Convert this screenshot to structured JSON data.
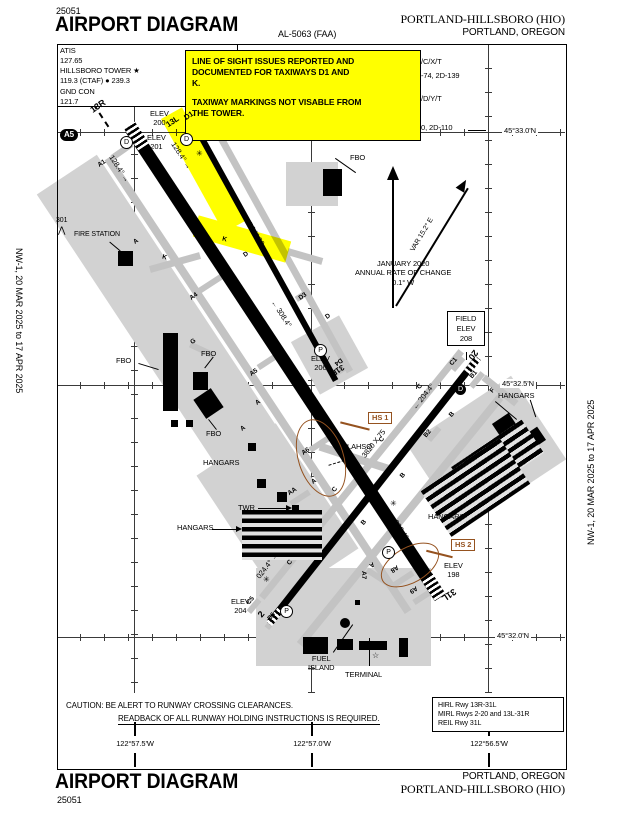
{
  "header": {
    "chart_code": "25051",
    "title": "AIRPORT DIAGRAM",
    "procedure_id": "AL-5063 (FAA)",
    "airport_name": "PORTLAND-HILLSBORO (HIO)",
    "city": "PORTLAND, OREGON"
  },
  "footer": {
    "title": "AIRPORT DIAGRAM",
    "chart_code": "25051",
    "city": "PORTLAND, OREGON",
    "airport_name": "PORTLAND-HILLSBORO (HIO)"
  },
  "margins": {
    "edition": "NW-1,  20 MAR 2025  to  17 APR 2025"
  },
  "comms": {
    "lines": [
      "ATIS",
      "127.65",
      "HILLSBORO TOWER ★",
      "119.3 (CTAF) ● 239.3",
      "GND CON",
      "121.7"
    ]
  },
  "note_box": {
    "lines": [
      "LINE OF SIGHT ISSUES REPORTED AND",
      "DOCUMENTED FOR TAXIWAYS D1 AND",
      "K.",
      "",
      "TAXIWAY MARKINGS NOT VISABLE FROM",
      "THE TOWER."
    ]
  },
  "runway_data_fragments": [
    "/C/X/T",
    "-74, 2D-139",
    "/D/Y/T",
    "0, 2D-110"
  ],
  "north_group": {
    "variation": "VAR 15.2° E",
    "annual": "JANUARY 2020\nANNUAL RATE OF CHANGE\n0.1° W"
  },
  "graticule": {
    "lat_labels": [
      "45°33.0'N",
      "45°32.5'N",
      "45°32.0'N"
    ],
    "lon_labels": [
      "122°57.5'W",
      "122°57.0'W",
      "122°56.5'W"
    ]
  },
  "caution": {
    "line1": "CAUTION: BE ALERT TO RUNWAY CROSSING CLEARANCES.",
    "line2": "READBACK OF ALL RUNWAY HOLDING INSTRUCTIONS IS REQUIRED."
  },
  "lighting_box": {
    "lines": [
      "HIRL Rwy 13R-31L",
      "MIRL Rwys 2-20 and 13L-31R",
      "REIL Rwy 31L"
    ]
  },
  "field_elev_box": {
    "lines": [
      "FIELD",
      "ELEV",
      "208"
    ]
  },
  "hotspots": [
    {
      "label": "HS 1"
    },
    {
      "label": "HS 2"
    }
  ],
  "colors": {
    "highlight": "#ffff00",
    "hotspot_brown": "#95521f",
    "taxiway_gray": "#c3c3c3"
  },
  "map": {
    "labels": [
      {
        "t": "13R",
        "x": 90,
        "y": 101,
        "r": -34,
        "fs": 9,
        "b": 1
      },
      {
        "t": "13L",
        "x": 166,
        "y": 117,
        "r": -34,
        "fs": 8,
        "b": 1
      },
      {
        "t": "D1",
        "x": 184,
        "y": 111,
        "r": -34,
        "fs": 7.5,
        "b": 1
      },
      {
        "t": "31R",
        "x": 330,
        "y": 365,
        "r": 146,
        "fs": 8,
        "b": 1
      },
      {
        "t": "31L",
        "x": 441,
        "y": 589,
        "r": 146,
        "fs": 9,
        "b": 1
      },
      {
        "t": "2",
        "x": 259,
        "y": 609,
        "r": -50,
        "fs": 9,
        "b": 1
      },
      {
        "t": "20",
        "x": 468,
        "y": 349,
        "r": 128,
        "fs": 9,
        "b": 1
      },
      {
        "t": "128.4° →",
        "x": 104,
        "y": 164,
        "r": 57,
        "fs": 7.5
      },
      {
        "t": "128.4° →",
        "x": 166,
        "y": 151,
        "r": 57,
        "fs": 7.5
      },
      {
        "t": "← 308.4°",
        "x": 266,
        "y": 309,
        "r": 57,
        "fs": 7.5
      },
      {
        "t": "← 308.4°",
        "x": 383,
        "y": 521,
        "r": 57,
        "fs": 7.5
      },
      {
        "t": "6600 X 150",
        "x": 247,
        "y": 327,
        "r": 57,
        "fs": 8.5
      },
      {
        "t": "3600 X 60",
        "x": 237,
        "y": 226,
        "r": 58,
        "fs": 7.5
      },
      {
        "t": "3820 X 75",
        "x": 357,
        "y": 439,
        "r": -52,
        "fs": 7.5
      },
      {
        "t": "024.4° →",
        "x": 252,
        "y": 561,
        "r": -52,
        "fs": 7.5
      },
      {
        "t": "← 204.4°",
        "x": 408,
        "y": 392,
        "r": -52,
        "fs": 7.5
      },
      {
        "t": "ELEV\n200",
        "x": 150,
        "y": 109,
        "fs": 7.5,
        "pre": 1
      },
      {
        "t": "ELEV\n201",
        "x": 147,
        "y": 133,
        "fs": 7.5,
        "pre": 1
      },
      {
        "t": "ELEV\n206",
        "x": 311,
        "y": 354,
        "fs": 7.5,
        "pre": 1
      },
      {
        "t": "ELEV\n204",
        "x": 231,
        "y": 597,
        "fs": 7.5,
        "pre": 1
      },
      {
        "t": "ELEV\n198",
        "x": 444,
        "y": 561,
        "fs": 7.5,
        "pre": 1
      },
      {
        "t": "A1",
        "x": 98,
        "y": 160,
        "r": -34,
        "fs": 6.5,
        "b": 1
      },
      {
        "t": "A",
        "x": 134,
        "y": 238,
        "r": -34,
        "fs": 6.5,
        "b": 1
      },
      {
        "t": "A4",
        "x": 190,
        "y": 293,
        "r": -34,
        "fs": 6.5,
        "b": 1
      },
      {
        "t": "A5",
        "x": 250,
        "y": 369,
        "r": -34,
        "fs": 6.5,
        "b": 1
      },
      {
        "t": "A",
        "x": 256,
        "y": 399,
        "r": -34,
        "fs": 6.5,
        "b": 1
      },
      {
        "t": "A",
        "x": 241,
        "y": 425,
        "r": -34,
        "fs": 6.5,
        "b": 1
      },
      {
        "t": "A6",
        "x": 302,
        "y": 448,
        "r": -34,
        "fs": 6.5,
        "b": 1
      },
      {
        "t": "A",
        "x": 312,
        "y": 478,
        "r": -34,
        "fs": 6.5,
        "b": 1
      },
      {
        "t": "AA",
        "x": 288,
        "y": 488,
        "r": -34,
        "fs": 6.5,
        "b": 1
      },
      {
        "t": "A7",
        "x": 359,
        "y": 571,
        "r": 90,
        "fs": 6.5,
        "b": 1
      },
      {
        "t": "A",
        "x": 369,
        "y": 560,
        "r": 146,
        "fs": 6.5,
        "b": 1
      },
      {
        "t": "A8",
        "x": 390,
        "y": 564,
        "r": 146,
        "fs": 6.5,
        "b": 1
      },
      {
        "t": "A9",
        "x": 409,
        "y": 585,
        "r": 146,
        "fs": 6.5,
        "b": 1
      },
      {
        "t": "B",
        "x": 450,
        "y": 411,
        "r": -50,
        "fs": 6.5,
        "b": 1
      },
      {
        "t": "B2",
        "x": 424,
        "y": 430,
        "r": -50,
        "fs": 6.5,
        "b": 1
      },
      {
        "t": "B",
        "x": 401,
        "y": 472,
        "r": -50,
        "fs": 6.5,
        "b": 1
      },
      {
        "t": "B",
        "x": 362,
        "y": 519,
        "r": -50,
        "fs": 6.5,
        "b": 1
      },
      {
        "t": "B5",
        "x": 268,
        "y": 613,
        "r": -50,
        "fs": 6.5,
        "b": 1
      },
      {
        "t": "B1",
        "x": 470,
        "y": 371,
        "r": -50,
        "fs": 6.5,
        "b": 1
      },
      {
        "t": "C",
        "x": 418,
        "y": 383,
        "r": -50,
        "fs": 6.5,
        "b": 1
      },
      {
        "t": "C1",
        "x": 450,
        "y": 358,
        "r": -50,
        "fs": 6.5,
        "b": 1
      },
      {
        "t": "C",
        "x": 380,
        "y": 436,
        "r": -50,
        "fs": 6.5,
        "b": 1
      },
      {
        "t": "C",
        "x": 333,
        "y": 486,
        "r": -50,
        "fs": 6.5,
        "b": 1
      },
      {
        "t": "C",
        "x": 288,
        "y": 559,
        "r": -50,
        "fs": 6.5,
        "b": 1
      },
      {
        "t": "C5",
        "x": 247,
        "y": 597,
        "r": -50,
        "fs": 6.5,
        "b": 1
      },
      {
        "t": "D",
        "x": 244,
        "y": 251,
        "r": -34,
        "fs": 6.5,
        "b": 1
      },
      {
        "t": "D3",
        "x": 299,
        "y": 293,
        "r": -34,
        "fs": 6.5,
        "b": 1
      },
      {
        "t": "D",
        "x": 326,
        "y": 313,
        "r": -34,
        "fs": 6.5,
        "b": 1
      },
      {
        "t": "D4",
        "x": 334,
        "y": 357,
        "r": 146,
        "fs": 6.5,
        "b": 1
      },
      {
        "t": "F",
        "x": 491,
        "y": 387,
        "r": -50,
        "fs": 6.5,
        "b": 1
      },
      {
        "t": "G",
        "x": 191,
        "y": 338,
        "r": -34,
        "fs": 6.5,
        "b": 1
      },
      {
        "t": "K",
        "x": 162,
        "y": 254,
        "r": 14,
        "fs": 6.5,
        "b": 1
      },
      {
        "t": "K",
        "x": 222,
        "y": 236,
        "r": 14,
        "fs": 6.5,
        "b": 1
      },
      {
        "t": "K",
        "x": 247,
        "y": 221,
        "r": 14,
        "fs": 6.5,
        "b": 1
      },
      {
        "t": "FIRE STATION",
        "x": 74,
        "y": 231,
        "fs": 7
      },
      {
        "t": "301",
        "x": 56,
        "y": 217,
        "fs": 7
      },
      {
        "t": "⋀",
        "x": 58,
        "y": 225,
        "fs": 9
      },
      {
        "t": "FBO",
        "x": 350,
        "y": 153,
        "fs": 7.5
      },
      {
        "t": "FBO",
        "x": 116,
        "y": 356,
        "fs": 7.5
      },
      {
        "t": "FBO",
        "x": 201,
        "y": 349,
        "fs": 7.5
      },
      {
        "t": "FBO",
        "x": 206,
        "y": 429,
        "fs": 7.5
      },
      {
        "t": "HANGARS",
        "x": 203,
        "y": 458,
        "fs": 7.5
      },
      {
        "t": "HANGARS",
        "x": 177,
        "y": 523,
        "fs": 7.5
      },
      {
        "t": "HANGARS",
        "x": 498,
        "y": 391,
        "fs": 7.5
      },
      {
        "t": "HANGARS",
        "x": 428,
        "y": 512,
        "fs": 7.5
      },
      {
        "t": "TWR",
        "x": 238,
        "y": 503,
        "fs": 7.5
      },
      {
        "t": "LAHSO",
        "x": 347,
        "y": 442,
        "fs": 7.5
      },
      {
        "t": "TERMINAL",
        "x": 345,
        "y": 670,
        "fs": 7.5
      },
      {
        "t": "FUEL\nISLAND",
        "x": 308,
        "y": 654,
        "fs": 7.5,
        "pre": 1
      },
      {
        "t": "266",
        "x": 372,
        "y": 642,
        "fs": 7
      },
      {
        "t": "☆",
        "x": 372,
        "y": 651,
        "fs": 8
      },
      {
        "t": "VAR 15.2° E",
        "x": 404,
        "y": 231,
        "r": -59,
        "fs": 7
      },
      {
        "t": "JANUARY 2020\nANNUAL RATE OF CHANGE\n0.1° W",
        "x": 355,
        "y": 259,
        "fs": 7.5,
        "pre": 1
      },
      {
        "t": "✳",
        "x": 390,
        "y": 499,
        "fs": 8
      },
      {
        "t": "✳",
        "x": 263,
        "y": 575,
        "fs": 8
      },
      {
        "t": "✳",
        "x": 196,
        "y": 149,
        "fs": 8
      },
      {
        "t": "P",
        "x": 314,
        "y": 344,
        "c": "circ"
      },
      {
        "t": "P",
        "x": 280,
        "y": 605,
        "c": "circ"
      },
      {
        "t": "P",
        "x": 382,
        "y": 546,
        "c": "circ"
      },
      {
        "t": "D",
        "x": 120,
        "y": 136,
        "c": "circ"
      },
      {
        "t": "D",
        "x": 180,
        "y": 133,
        "c": "circ"
      },
      {
        "t": "D",
        "x": 455,
        "y": 384,
        "c": "circf"
      },
      {
        "t": "A5",
        "x": 60,
        "y": 129,
        "c": "oval",
        "fs": 8
      }
    ]
  }
}
